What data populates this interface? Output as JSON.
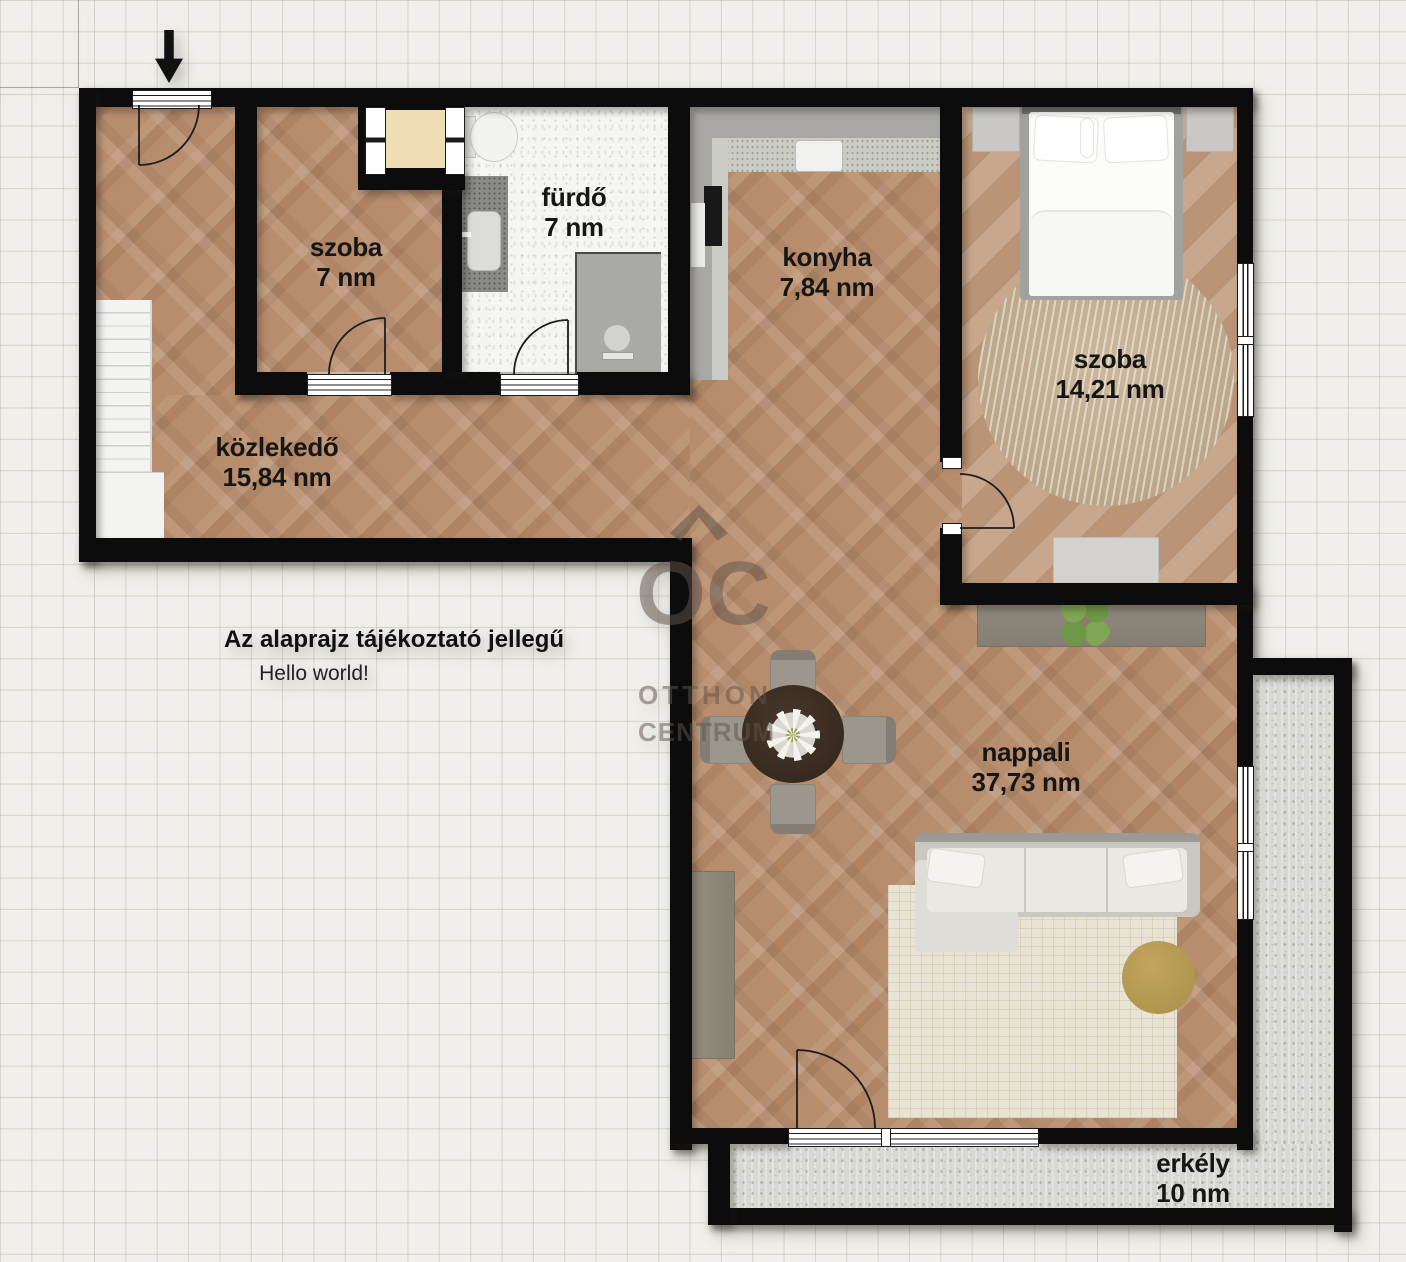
{
  "floorplan": {
    "disclaimer": "Az alaprajz tájékoztató jellegű",
    "note": "Hello world!",
    "watermark": {
      "monogram": "OC",
      "line1": "OTTHON",
      "line2": "CENTRUM"
    },
    "rooms": [
      {
        "name": "szoba",
        "area": "7 nm"
      },
      {
        "name": "fürdő",
        "area": "7 nm"
      },
      {
        "name": "konyha",
        "area": "7,84 nm"
      },
      {
        "name": "szoba",
        "area": "14,21 nm"
      },
      {
        "name": "közlekedő",
        "area": "15,84 nm"
      },
      {
        "name": "nappali",
        "area": "37,73 nm"
      },
      {
        "name": "erkély",
        "area": "10 nm"
      }
    ],
    "colors": {
      "wall": "#0c0c0c",
      "wood": "#b88d6d",
      "bedroom_wood": "#c19b7d",
      "bathroom_floor": "#f5f5f2",
      "concrete": "#d8d8d4",
      "background": "#f0efeb",
      "label_text": "#161616"
    }
  }
}
